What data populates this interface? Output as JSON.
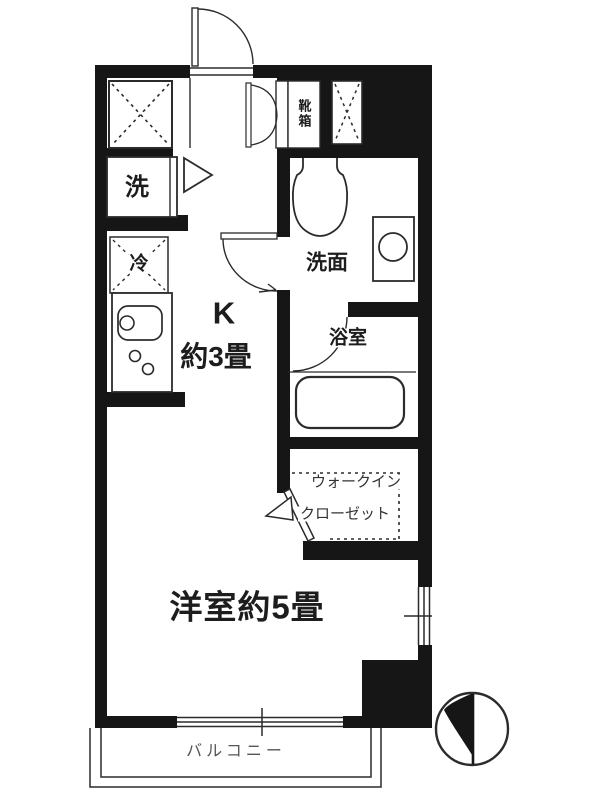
{
  "plan_title": "apartment-floor-plan",
  "colors": {
    "wall": "#161616",
    "line": "#2b2b2b",
    "text": "#1d1d1d",
    "balcony_text": "#555555"
  },
  "rooms": {
    "kitchen": {
      "label_line1": "K",
      "label_line2": "約3畳"
    },
    "western_room": {
      "label": "洋室約5畳"
    },
    "washroom": {
      "label": "洗面"
    },
    "bathroom": {
      "label": "浴室"
    },
    "walk_in_closet": {
      "label_line1": "ウォークイン",
      "label_line2": "クローゼット"
    },
    "balcony": {
      "label": "バルコニー"
    }
  },
  "fixtures": {
    "laundry_space": {
      "label": "洗"
    },
    "refrigerator_space": {
      "label": "冷"
    },
    "shoe_cabinet": {
      "label": "靴箱"
    }
  },
  "icons": {
    "entrance_door": "quarter-arc swing door",
    "double_closet_door": "double arc doors",
    "washroom_door": "quarter-arc swing door with arrow",
    "bathroom_door": "quarter-arc swing door",
    "wic_door": "angled leaf with triangle",
    "toilet": "tank and oval bowl",
    "washbasin": "counter square with round bowl",
    "bathtub": "rounded rectangle tub",
    "kitchen_sink": "rounded sink with faucet circle",
    "stove_burners": "two small circles",
    "window_right": "double-line window with mullion tick",
    "window_balcony": "double-line sliding window with mullion tick",
    "hatched_storage": "dashed X box",
    "north_compass": "circle with black needle"
  }
}
